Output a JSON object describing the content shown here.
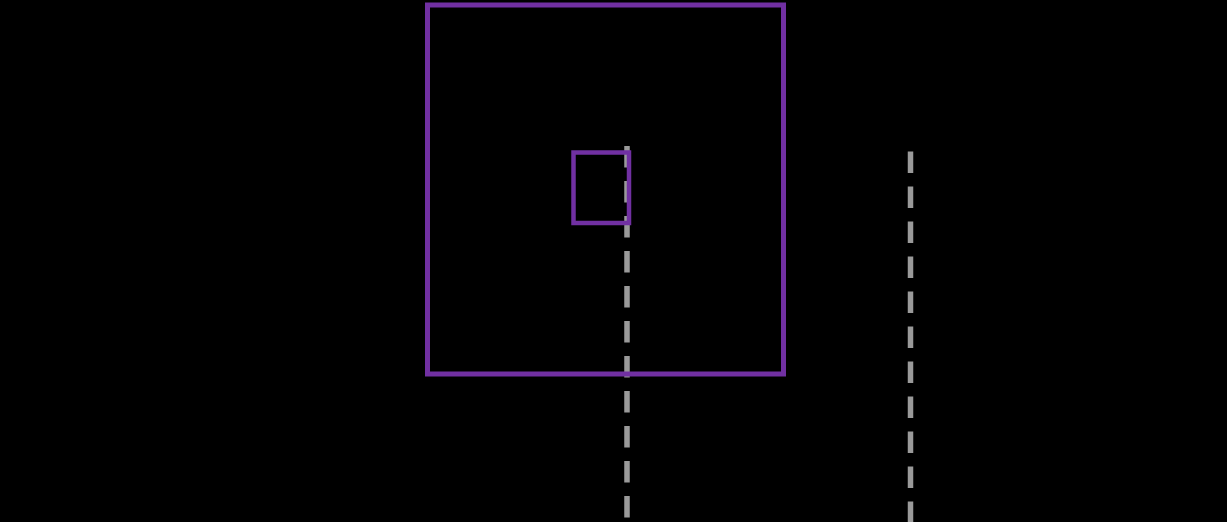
{
  "canvas": {
    "width": 1227,
    "height": 522,
    "background": "#000000"
  },
  "colors": {
    "square_stroke": "#7130A2",
    "dashed_line_stroke": "#9A9A9A"
  },
  "shapes": {
    "background": {
      "x": 0,
      "y": 0,
      "width": 1227,
      "height": 522,
      "fill": "#000000"
    },
    "outer_square": {
      "x": 427.5,
      "y": 5,
      "width": 356,
      "height": 369,
      "fill": "none",
      "stroke": "#7130A2",
      "stroke_width": 5
    },
    "inner_square": {
      "x": 573.5,
      "y": 152.5,
      "width": 55.5,
      "height": 70.5,
      "fill": "none",
      "stroke": "#7130A2",
      "stroke_width": 4.5
    },
    "center_dashed_line": {
      "x1": 627,
      "y1": 146,
      "x2": 627,
      "y2": 522,
      "stroke": "#9A9A9A",
      "stroke_width": 5.5,
      "stroke_dasharray": "21.5 13.5",
      "stroke_linecap": "butt"
    },
    "right_dashed_line": {
      "x1": 910.5,
      "y1": 151.5,
      "x2": 910.5,
      "y2": 522,
      "stroke": "#9A9A9A",
      "stroke_width": 5.5,
      "stroke_dasharray": "21.5 13.5",
      "stroke_linecap": "butt"
    }
  }
}
